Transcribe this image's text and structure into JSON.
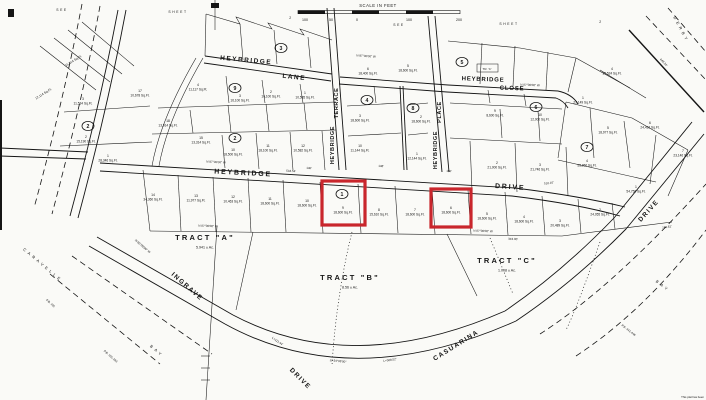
{
  "map": {
    "paper_color": "#fafaf7",
    "ink_color": "#151515",
    "highlight_color": "#c9262c",
    "sheet_notes": [
      {
        "text": "SEE",
        "x": 62,
        "y": 11
      },
      {
        "text": "SHEET",
        "x": 178,
        "y": 13
      },
      {
        "text": "2",
        "x": 291,
        "y": 19
      },
      {
        "text": "SEE",
        "x": 399,
        "y": 26
      },
      {
        "text": "SHEET",
        "x": 509,
        "y": 25
      },
      {
        "text": "2",
        "x": 601,
        "y": 23
      }
    ],
    "scale_bar": {
      "label": "SCALE IN FEET",
      "ticks": [
        {
          "t": "100",
          "x": 305
        },
        {
          "t": "50",
          "x": 331
        },
        {
          "t": "0",
          "x": 357
        },
        {
          "t": "100",
          "x": 409
        },
        {
          "t": "200",
          "x": 459
        }
      ]
    },
    "street_labels": [
      {
        "text": "HEYBRIDGE",
        "x": 246,
        "y": 62,
        "rot": 5,
        "size": 6.5,
        "sp": 1.5
      },
      {
        "text": "LANE",
        "x": 294,
        "y": 79,
        "rot": 6,
        "size": 6.5,
        "sp": 1.5
      },
      {
        "text": "HEYBRIDGE",
        "x": 483,
        "y": 81,
        "rot": 2,
        "size": 6,
        "sp": 0.8
      },
      {
        "text": "CLOSE",
        "x": 512,
        "y": 90,
        "rot": 2,
        "size": 6,
        "sp": 0.8
      },
      {
        "text": "TERRACE",
        "x": 338,
        "y": 103,
        "rot": -90,
        "size": 5.5,
        "sp": 0.6
      },
      {
        "text": "HEYBRIDGE",
        "x": 334,
        "y": 145,
        "rot": -90,
        "size": 5.5,
        "sp": 0.6
      },
      {
        "text": "PLACE",
        "x": 441,
        "y": 112,
        "rot": -90,
        "size": 5.5,
        "sp": 0.6
      },
      {
        "text": "HEYBRIDGE",
        "x": 437,
        "y": 150,
        "rot": -90,
        "size": 5.5,
        "sp": 0.6
      },
      {
        "text": "HEYBRIDGE",
        "x": 243,
        "y": 175,
        "rot": 3,
        "size": 7,
        "sp": 1.8
      },
      {
        "text": "DRIVE",
        "x": 510,
        "y": 189,
        "rot": 4,
        "size": 7,
        "sp": 1.8
      },
      {
        "text": "INGRAVE",
        "x": 186,
        "y": 288,
        "rot": 41,
        "size": 6.5,
        "sp": 1.5
      },
      {
        "text": "DRIVE",
        "x": 299,
        "y": 380,
        "rot": 45,
        "size": 6.5,
        "sp": 1.5
      },
      {
        "text": "CASUARINA",
        "x": 457,
        "y": 347,
        "rot": -32,
        "size": 6.5,
        "sp": 1.5
      },
      {
        "text": "DRIVE",
        "x": 650,
        "y": 212,
        "rot": -48,
        "size": 6.5,
        "sp": 1.5
      }
    ],
    "area_labels": [
      {
        "text": "CARAVELLE",
        "x": 42,
        "y": 266,
        "rot": 40,
        "size": 4,
        "sp": 3
      },
      {
        "text": "BAY",
        "x": 156,
        "y": 352,
        "rot": 40,
        "size": 4,
        "sp": 3
      },
      {
        "text": "DERBY",
        "x": 680,
        "y": 30,
        "rot": 62,
        "size": 4,
        "sp": 3
      },
      {
        "text": "BAY",
        "x": 662,
        "y": 287,
        "rot": 38,
        "size": 4,
        "sp": 3
      }
    ],
    "block_circles": [
      {
        "n": "3",
        "x": 281,
        "y": 48
      },
      {
        "n": "9",
        "x": 235,
        "y": 88
      },
      {
        "n": "2",
        "x": 88,
        "y": 126
      },
      {
        "n": "2",
        "x": 235,
        "y": 138
      },
      {
        "n": "4",
        "x": 367,
        "y": 100
      },
      {
        "n": "8",
        "x": 413,
        "y": 108
      },
      {
        "n": "5",
        "x": 462,
        "y": 62
      },
      {
        "n": "6",
        "x": 536,
        "y": 107
      },
      {
        "n": "7",
        "x": 587,
        "y": 147
      },
      {
        "n": "1",
        "x": 342,
        "y": 194
      }
    ],
    "lots": [
      {
        "n": "14",
        "sqft": "34,360 Sq.Ft.",
        "x": 153,
        "y": 196
      },
      {
        "n": "13",
        "sqft": "11,977 Sq.Ft.",
        "x": 196,
        "y": 197
      },
      {
        "n": "12",
        "sqft": "10,463 Sq.Ft.",
        "x": 233,
        "y": 198
      },
      {
        "n": "11",
        "sqft": "18,600 Sq.Ft.",
        "x": 270,
        "y": 200
      },
      {
        "n": "10",
        "sqft": "18,600 Sq.Ft.",
        "x": 307,
        "y": 202
      },
      {
        "n": "9",
        "sqft": "18,600 Sq.Ft.",
        "x": 343,
        "y": 209
      },
      {
        "n": "8",
        "sqft": "15,610 Sq.Ft.",
        "x": 379,
        "y": 211
      },
      {
        "n": "7",
        "sqft": "18,600 Sq.Ft.",
        "x": 415,
        "y": 211
      },
      {
        "n": "6",
        "sqft": "18,600 Sq.Ft.",
        "x": 451,
        "y": 209
      },
      {
        "n": "5",
        "sqft": "18,600 Sq.Ft.",
        "x": 487,
        "y": 215
      },
      {
        "n": "4",
        "sqft": "18,600 Sq.Ft.",
        "x": 524,
        "y": 218
      },
      {
        "n": "3",
        "sqft": "20,489 Sq.Ft.",
        "x": 560,
        "y": 222
      },
      {
        "n": "2",
        "sqft": "24,055 Sq.Ft.",
        "x": 600,
        "y": 211
      },
      {
        "n": "1",
        "sqft": "54,756 Sq.Ft.",
        "x": 636,
        "y": 188
      },
      {
        "n": "3",
        "sqft": "11,534 Sq.Ft.",
        "x": 83,
        "y": 100
      },
      {
        "n": "17",
        "sqft": "10,678 Sq.Ft.",
        "x": 140,
        "y": 92
      },
      {
        "n": "4",
        "sqft": "11,117 Sq.Ft.",
        "x": 198,
        "y": 86
      },
      {
        "n": "18",
        "sqft": "13,914 Sq.Ft.",
        "x": 168,
        "y": 122
      },
      {
        "n": "2",
        "sqft": "15,190 Sq.Ft.",
        "x": 86,
        "y": 138
      },
      {
        "n": "15",
        "sqft": "13,314 Sq.Ft.",
        "x": 201,
        "y": 139
      },
      {
        "n": "1",
        "sqft": "28,346 Sq.Ft.",
        "x": 108,
        "y": 157
      },
      {
        "n": "10",
        "sqft": "18,500 Sq.Ft.",
        "x": 233,
        "y": 151
      },
      {
        "n": "11",
        "sqft": "18,100 Sq.Ft.",
        "x": 268,
        "y": 147
      },
      {
        "n": "12",
        "sqft": "10,582 Sq.Ft.",
        "x": 303,
        "y": 147
      },
      {
        "n": "3",
        "sqft": "16,100 Sq.Ft.",
        "x": 240,
        "y": 97
      },
      {
        "n": "2",
        "sqft": "16,100 Sq.Ft.",
        "x": 271,
        "y": 93
      },
      {
        "n": "1",
        "sqft": "10,585 Sq.Ft.",
        "x": 305,
        "y": 94
      },
      {
        "n": "6",
        "sqft": "18,400 Sq.Ft.",
        "x": 368,
        "y": 70
      },
      {
        "n": "5",
        "sqft": "18,600 Sq.Ft.",
        "x": 408,
        "y": 67
      },
      {
        "n": "3",
        "sqft": "18,600 Sq.Ft.",
        "x": 360,
        "y": 117
      },
      {
        "n": "10",
        "sqft": "11,144 Sq.Ft.",
        "x": 360,
        "y": 147
      },
      {
        "n": "2",
        "sqft": "18,600 Sq.Ft.",
        "x": 421,
        "y": 118
      },
      {
        "n": "1",
        "sqft": "12,144 Sq.Ft.",
        "x": 417,
        "y": 155
      },
      {
        "n": "9",
        "sqft": "8,600 Sq.Ft.",
        "x": 495,
        "y": 112
      },
      {
        "n": "10",
        "sqft": "12,000 Sq.Ft.",
        "x": 540,
        "y": 116
      },
      {
        "n": "1",
        "sqft": "22,149 Sq.Ft.",
        "x": 583,
        "y": 99
      },
      {
        "n": "4",
        "sqft": "18,524 Sq.Ft.",
        "x": 612,
        "y": 70
      },
      {
        "n": "2",
        "sqft": "21,000 Sq.Ft.",
        "x": 497,
        "y": 164
      },
      {
        "n": "3",
        "sqft": "21,746 Sq.Ft.",
        "x": 540,
        "y": 166
      },
      {
        "n": "5",
        "sqft": "18,977 Sq.Ft.",
        "x": 608,
        "y": 129
      },
      {
        "n": "6",
        "sqft": "24,416 Sq.Ft.",
        "x": 650,
        "y": 124
      },
      {
        "n": "7",
        "sqft": "23,146 Sq.Ft.",
        "x": 683,
        "y": 152
      },
      {
        "n": "4",
        "sqft": "58,866 Sq.Ft.",
        "x": 587,
        "y": 162
      },
      {
        "n": "",
        "sqft": "12,114 Sq.Ft.",
        "x": 44,
        "y": 90,
        "rot": -32
      },
      {
        "n": "",
        "sqft": "15,814 Sq.Ft.",
        "x": 74,
        "y": 57,
        "rot": -32
      }
    ],
    "tracts": [
      {
        "name": "TRACT  \"A\"",
        "acreage": "5.941 ± Ac.",
        "x": 205,
        "y": 240
      },
      {
        "name": "TRACT  \"B\"",
        "acreage": "8.56 ± Ac.",
        "x": 350,
        "y": 280
      },
      {
        "name": "TRACT  \"C\"",
        "acreage": "1.008 ± Ac.",
        "x": 507,
        "y": 263
      }
    ],
    "dimensions": [
      {
        "text": "N 87°00'00\" W",
        "x": 216,
        "y": 163,
        "rot": 3
      },
      {
        "text": "534.54'",
        "x": 291,
        "y": 172,
        "rot": 3
      },
      {
        "text": "N 87°00'00\" W",
        "x": 366,
        "y": 57,
        "rot": 4
      },
      {
        "text": "N 87°00'00\" W",
        "x": 530,
        "y": 86,
        "rot": 2
      },
      {
        "text": "N 87°00'00\" W",
        "x": 208,
        "y": 227,
        "rot": 2
      },
      {
        "text": "N 87°00'00\" W",
        "x": 483,
        "y": 232,
        "rot": 2
      },
      {
        "text": "744.61'",
        "x": 667,
        "y": 228,
        "rot": -10
      },
      {
        "text": "343.80'",
        "x": 513,
        "y": 240,
        "rot": 2
      },
      {
        "text": "N 60°00'00\" W",
        "x": 142,
        "y": 247,
        "rot": 41
      },
      {
        "text": "L=111.44'",
        "x": 277,
        "y": 342,
        "rot": 34
      },
      {
        "text": "Δ=34°06'00\"",
        "x": 338,
        "y": 362,
        "rot": 6
      },
      {
        "text": "L=568.52'",
        "x": 390,
        "y": 361,
        "rot": -8
      },
      {
        "text": "510.10'",
        "x": 549,
        "y": 184,
        "rot": -8
      },
      {
        "text": "448.24'",
        "x": 663,
        "y": 63,
        "rot": 47
      },
      {
        "text": "P.B. 101",
        "x": 50,
        "y": 304,
        "rot": 41
      },
      {
        "text": "P.B. 101-103",
        "x": 110,
        "y": 357,
        "rot": 41
      },
      {
        "text": "P.B. 441-446",
        "x": 628,
        "y": 331,
        "rot": 38
      },
      {
        "text": "TR. 'C'",
        "x": 487,
        "y": 70,
        "rot": 0
      },
      {
        "text": "148'",
        "x": 381,
        "y": 167,
        "rot": 3
      },
      {
        "text": "140'",
        "x": 309,
        "y": 169,
        "rot": 3
      },
      {
        "text": "150'",
        "x": 449,
        "y": 172,
        "rot": 3
      }
    ],
    "highlights": [
      {
        "x": 322,
        "y": 181,
        "w": 43,
        "h": 44
      },
      {
        "x": 431,
        "y": 189,
        "w": 40,
        "h": 38
      }
    ],
    "corner_note": "This plat has been"
  }
}
